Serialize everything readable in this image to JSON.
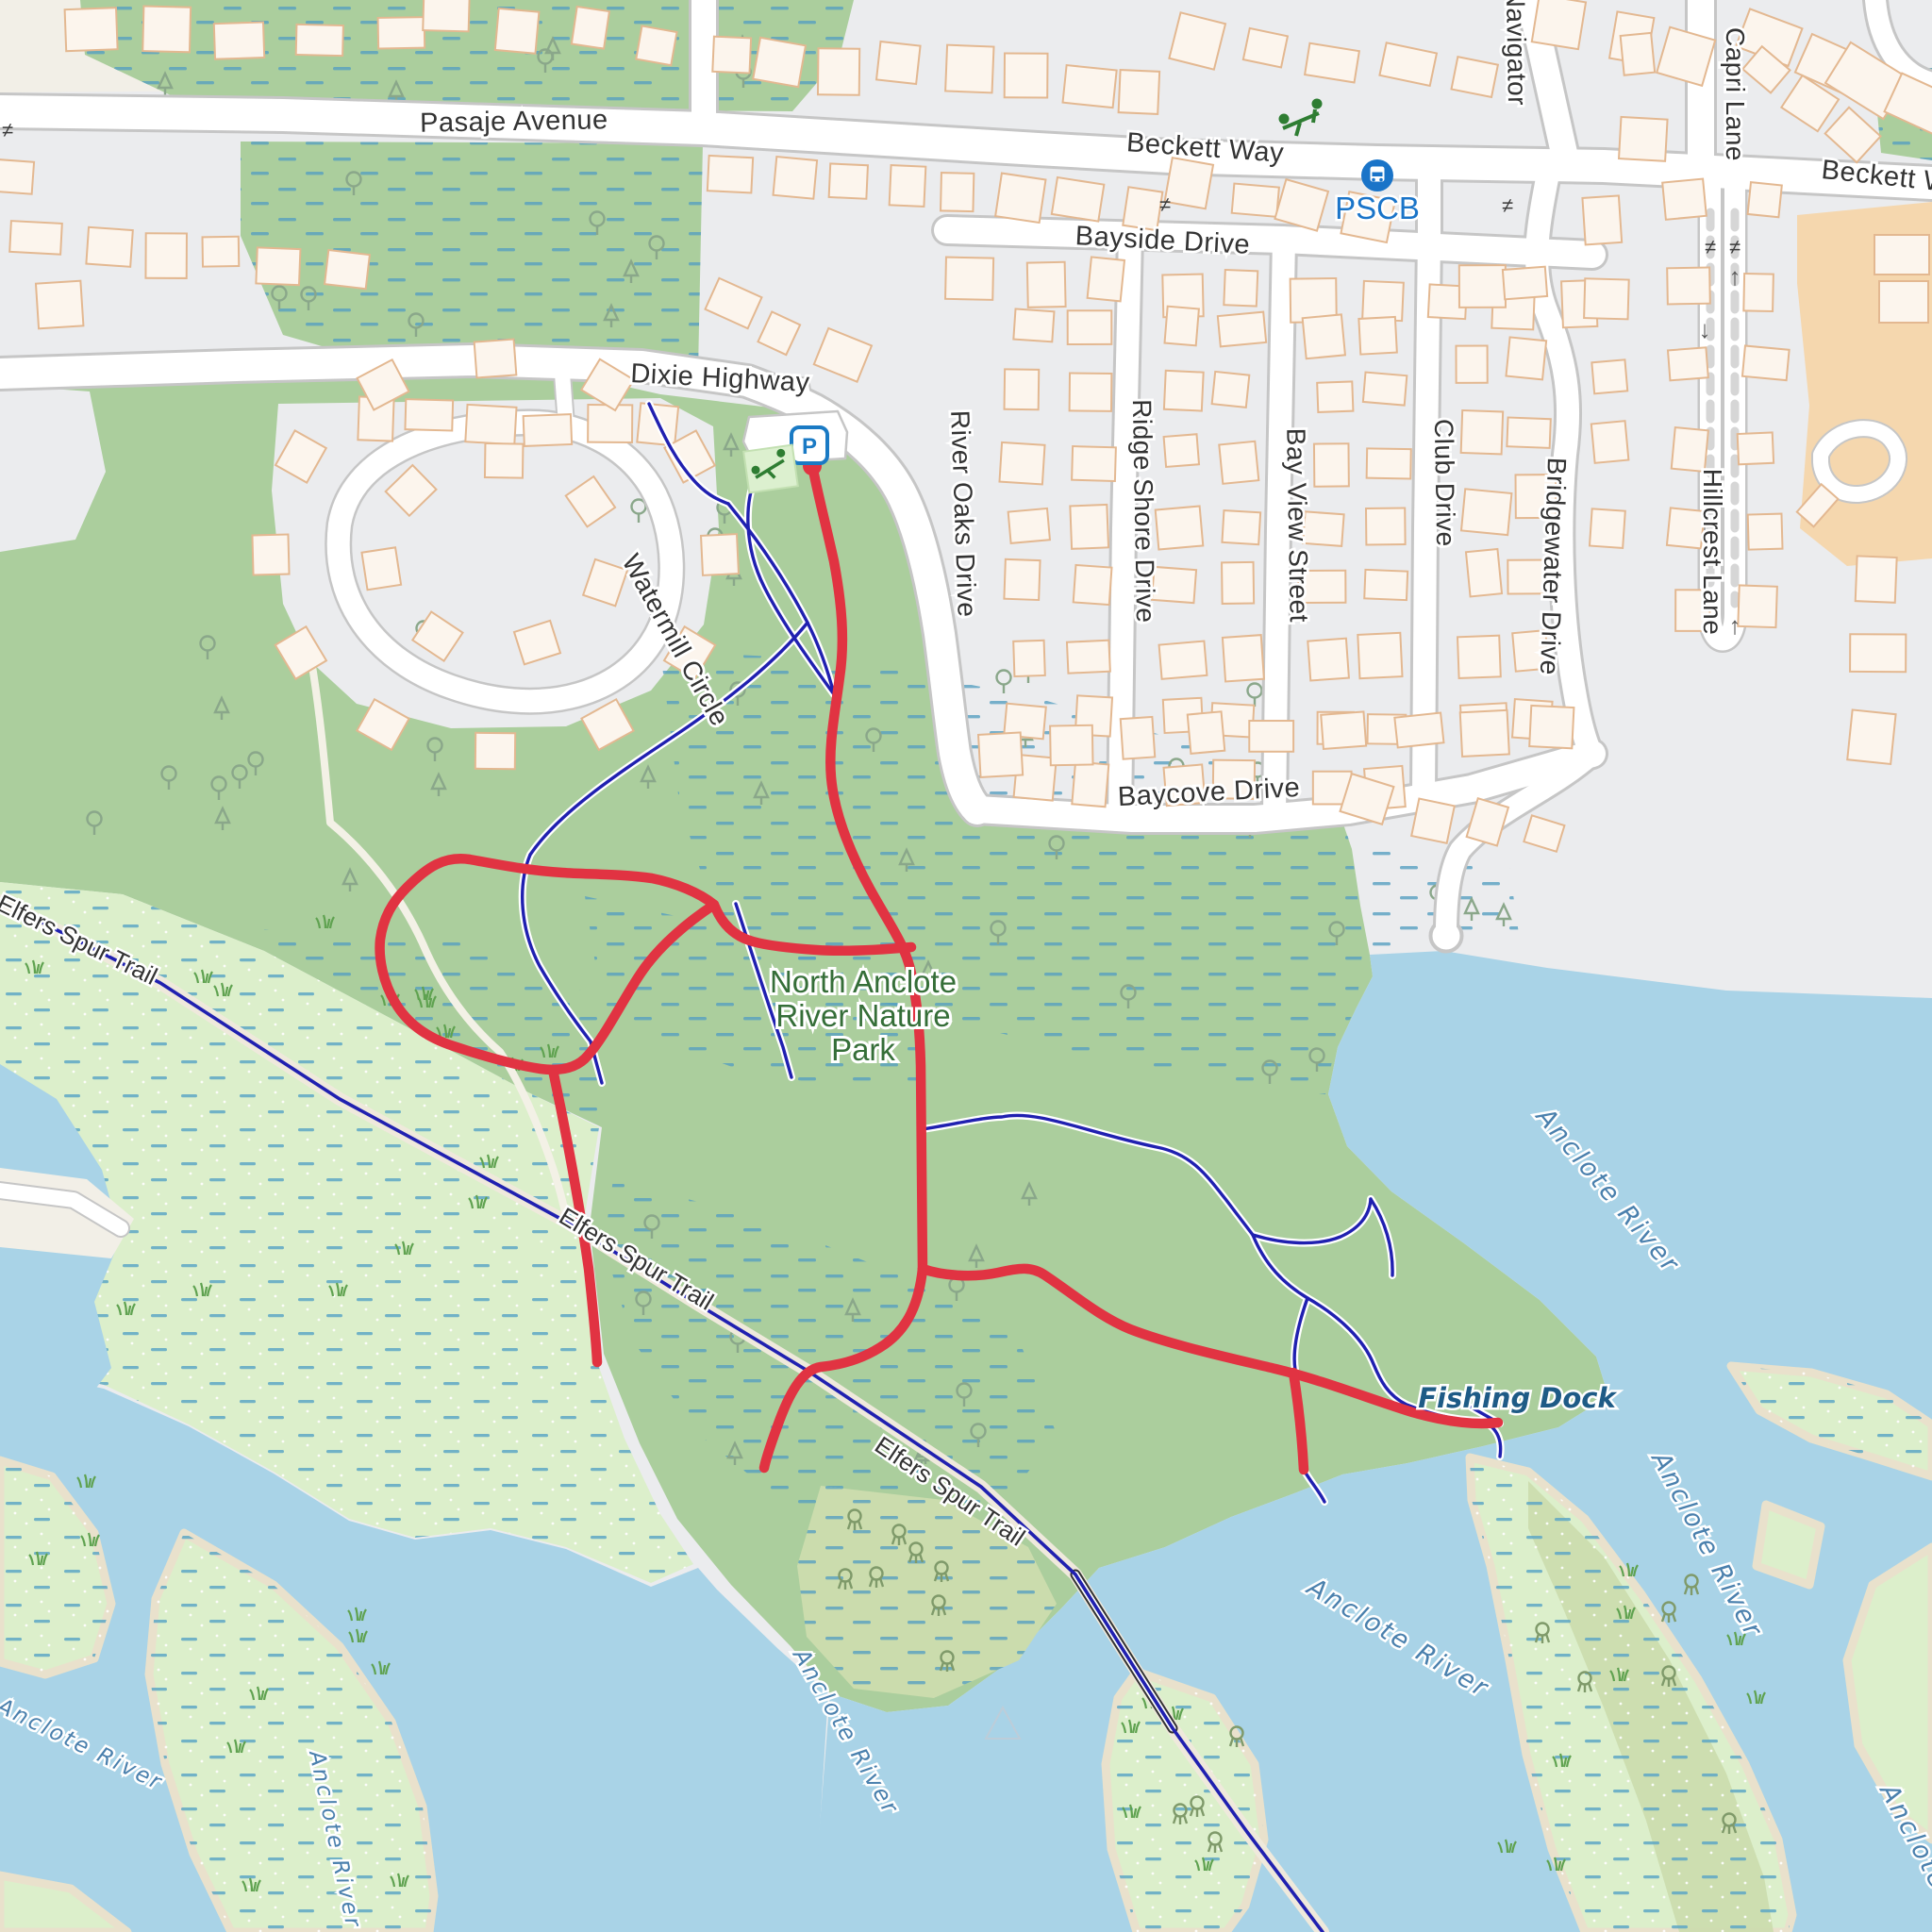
{
  "map": {
    "description": "OpenStreetMap-style map of North Anclote River Nature Park with red GPS route overlay",
    "park_name": [
      "North Anclote",
      "River Nature",
      "Park"
    ],
    "streets": {
      "pasaje": "Pasaje Avenue",
      "beckett": "Beckett Way",
      "beckett_clipped": "Beckett W",
      "bayside": "Bayside Drive",
      "dixie": "Dixie Highway",
      "watermill": "Watermill Circle",
      "river_oaks": "River Oaks Drive",
      "ridge_shore": "Ridge Shore Drive",
      "bay_view": "Bay View Street",
      "club": "Club Drive",
      "bridgewater": "Bridgewater Drive",
      "baycove": "Baycove Drive",
      "navigator": "Navigator",
      "capri": "Capri Lane",
      "hillcrest": "Hillcrest Lane"
    },
    "trail_name": "Elfers Spur Trail",
    "river_name": "Anclote River",
    "poi": {
      "bus_stop_code": "PSCB",
      "fishing_dock": "Fishing Dock",
      "parking_letter": "P"
    },
    "icons": {
      "gate_glyph": "≠",
      "oneway_up": "↑",
      "oneway_down": "↓",
      "bus_icon": "bus-stop",
      "parking_icon": "parking",
      "playground_icon": "playground-seesaw"
    },
    "colors": {
      "water": "#a9d3e7",
      "park_green": "#abce9d",
      "marsh": "#dcefcb",
      "wetland_dash": "#58a0c0",
      "mangrove_olive": "#cbdcad",
      "sand_edge": "#e9e1cc",
      "urban_gray": "#ebecee",
      "beige": "#f2efe7",
      "road_fill": "#ffffff",
      "road_casing": "#c6c6c6",
      "building_fill": "#fcf5ed",
      "building_stroke": "#e3b891",
      "commercial": "#f5d7ae",
      "route_red": "#e13342",
      "trail_blue": "#2020b0",
      "bus_blue": "#1a74c8"
    }
  }
}
